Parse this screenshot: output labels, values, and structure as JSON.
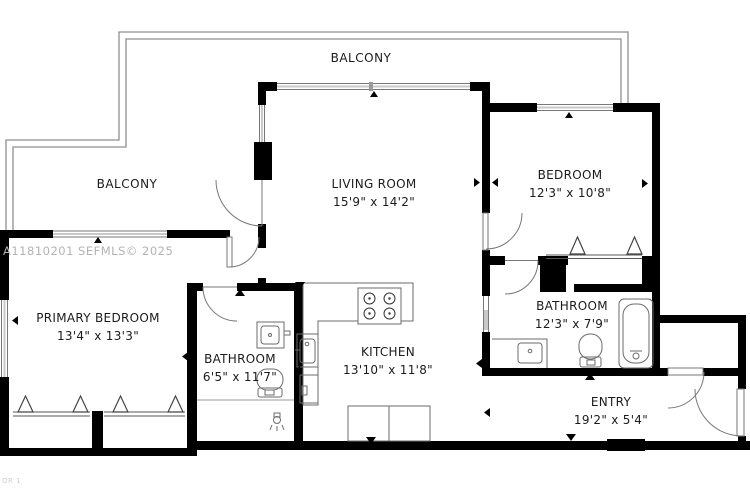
{
  "watermark": {
    "text": "A11810201  SEFMLS© 2025"
  },
  "footer": {
    "text": "OR 1"
  },
  "labels": {
    "balcony_top": "BALCONY",
    "balcony_left": "BALCONY"
  },
  "rooms": {
    "living": {
      "name": "LIVING ROOM",
      "dims": "15'9\" x 14'2\""
    },
    "bedroom": {
      "name": "BEDROOM",
      "dims": "12'3\" x 10'8\""
    },
    "primary": {
      "name": "PRIMARY BEDROOM",
      "dims": "13'4\" x 13'3\""
    },
    "bathroom1": {
      "name": "BATHROOM",
      "dims": "6'5\" x 11'7\""
    },
    "kitchen": {
      "name": "KITCHEN",
      "dims": "13'10\" x 11'8\""
    },
    "bathroom2": {
      "name": "BATHROOM",
      "dims": "12'3\" x 7'9\""
    },
    "entry": {
      "name": "ENTRY",
      "dims": "19'2\" x 5'4\""
    }
  },
  "colors": {
    "wall": "#000000",
    "railing": "#8f8f8f",
    "fixture_line": "#6b6b6b",
    "window_line": "#777777",
    "watermark": "#b3b3b3",
    "text": "#1b1b1b"
  },
  "fixtures": [
    "stove-icon",
    "kitchen-sink-icon",
    "dishwasher-icon",
    "bathtub-icon",
    "toilet-icon",
    "vanity-sink-icon",
    "shower-icon",
    "wardrobe-icon",
    "door-swing-icon",
    "window-icon",
    "balcony-railing"
  ]
}
